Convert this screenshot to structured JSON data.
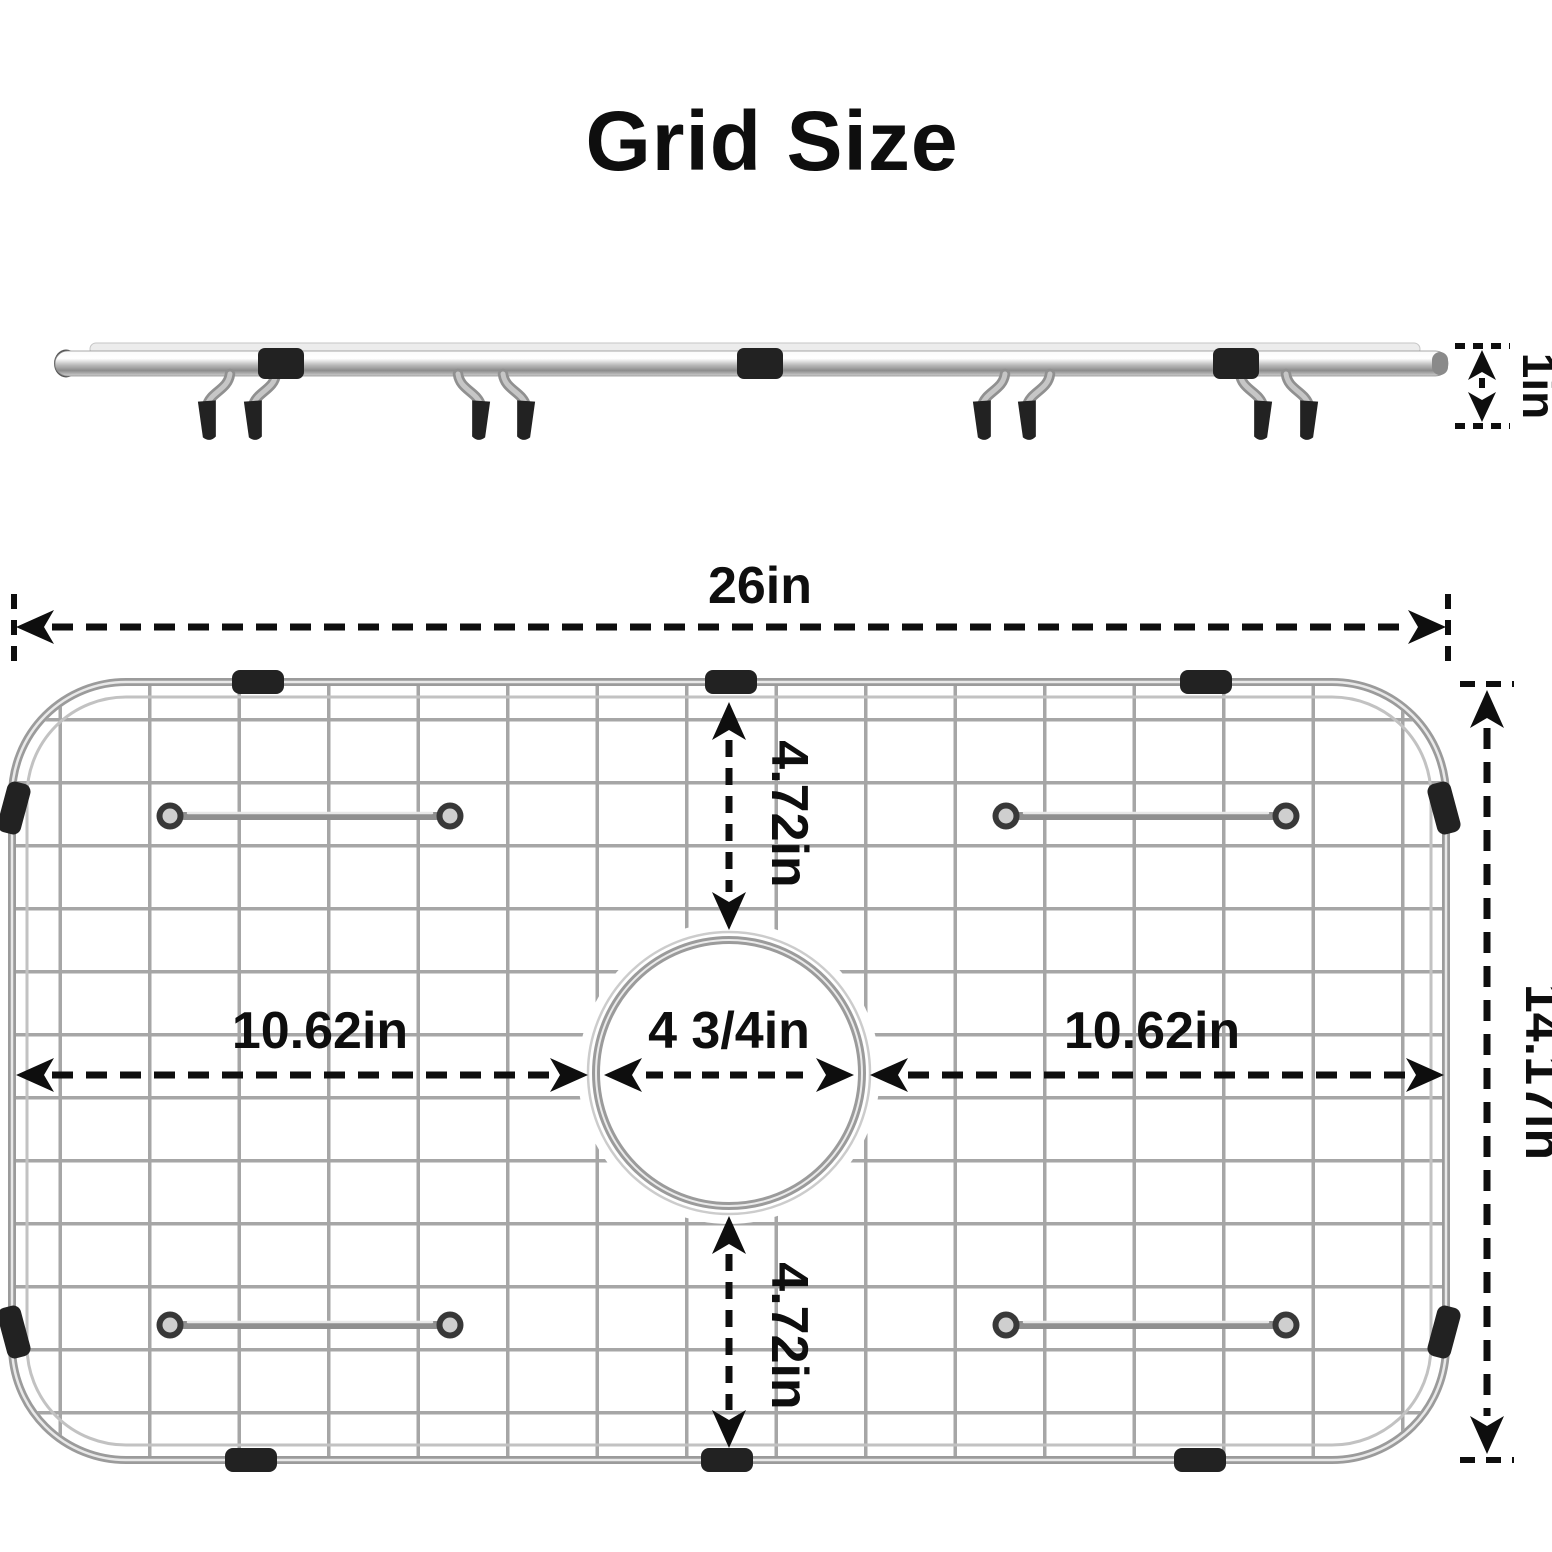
{
  "title": "Grid Size",
  "colors": {
    "background": "#ffffff",
    "dimension_ink": "#0e0e0e",
    "metal_light": "#ececec",
    "metal_mid": "#ababab",
    "metal_dark": "#8c8c8c",
    "rubber_black": "#222222"
  },
  "side_view": {
    "height_dim": "1in"
  },
  "top_view": {
    "width_dim": "26in",
    "height_dim": "14.17in",
    "left_span_dim": "10.62in",
    "drain_dim": "4 3/4in",
    "right_span_dim": "10.62in",
    "top_offset_dim": "4.72in",
    "bottom_offset_dim": "4.72in"
  }
}
